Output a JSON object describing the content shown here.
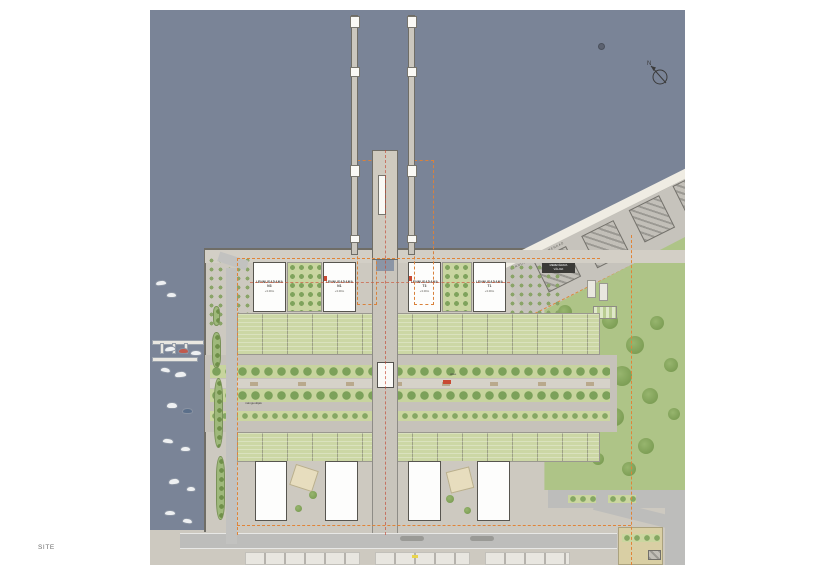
{
  "page": {
    "site_label": "SITE"
  },
  "compass": {
    "north_label": "N"
  },
  "buildings_north": [
    {
      "name": "LENNUSADAMA N3",
      "level": "+3.00m"
    },
    {
      "name": "LENNUSADAMA N1",
      "level": "+3.00m"
    },
    {
      "name": "LENNUSADAMA T3",
      "level": "+3.00m"
    },
    {
      "name": "LENNUSADAMA T1",
      "level": "+3.00m"
    }
  ],
  "labels": {
    "seawall": "LENNUSADAMA PROMENAAD",
    "plaza_line1": "MEREVÄRAVA",
    "plaza_line2": "VÄLJAK",
    "allee": "allee",
    "playground": "mänguväljak"
  },
  "colors": {
    "water": "#7A8497",
    "quay": "#CDC9C0",
    "road": "#BDBDBB",
    "park": "#AEC487",
    "garden": "#CCD7A5",
    "building": "#FDFDFC",
    "boundary_orange": "#E08438",
    "marker_red": "#C84A33"
  }
}
